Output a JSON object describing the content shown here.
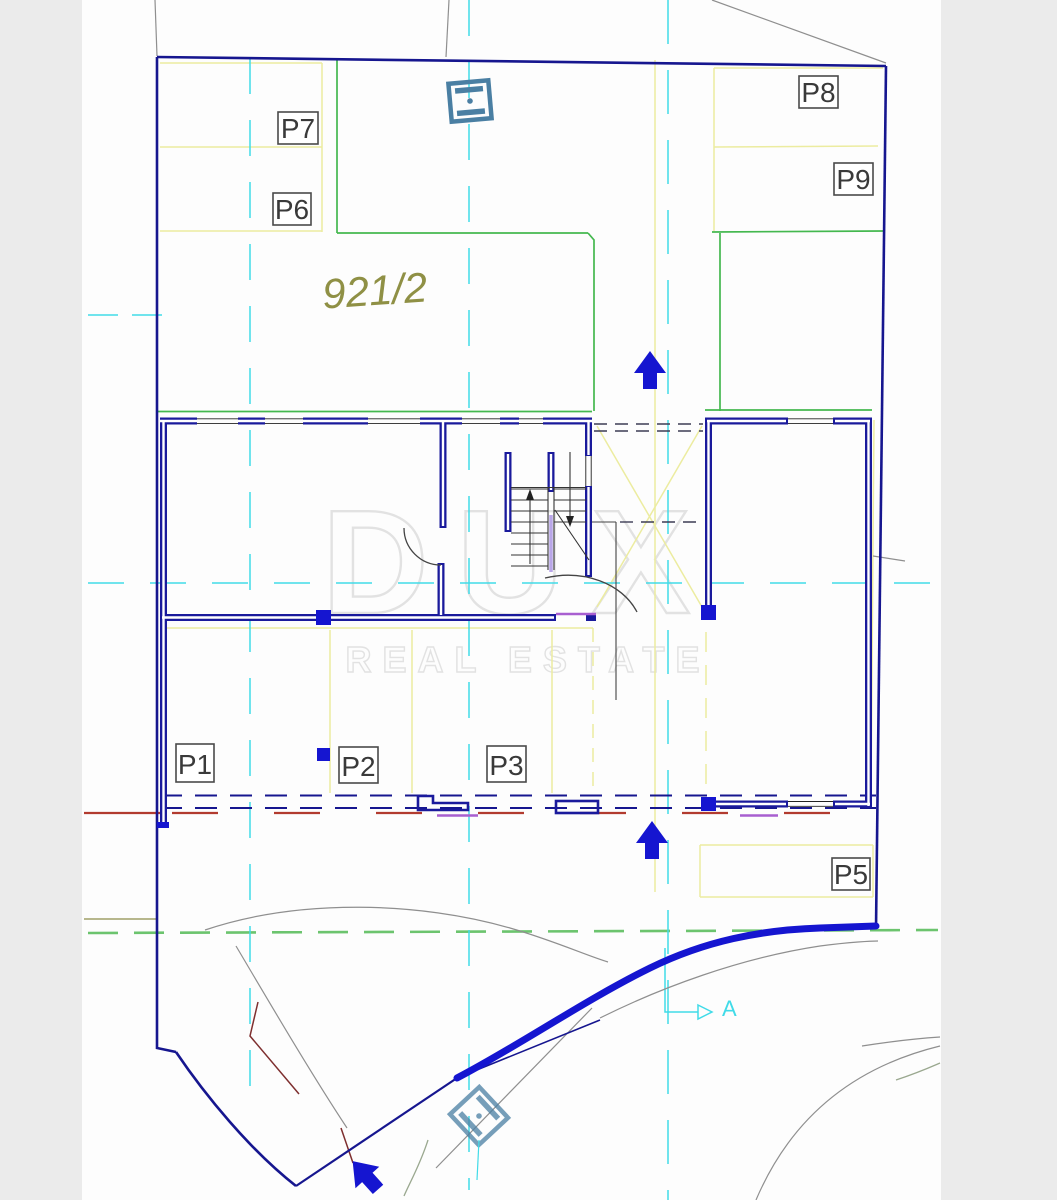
{
  "parcel": {
    "number": "921/2"
  },
  "watermark": {
    "brand": "DUX",
    "tagline": "REAL ESTATE"
  },
  "section": {
    "label": "A"
  },
  "parking": {
    "labels": [
      "P1",
      "P2",
      "P3",
      "P5",
      "P6",
      "P7",
      "P8",
      "P9"
    ]
  },
  "icons": [
    "up-arrow-icon",
    "entrance-arrow-icon",
    "utility-manhole-icon",
    "section-arrow-icon"
  ],
  "colors": {
    "margin_gray": "#ebebeb",
    "paper_white": "#fdfdfd",
    "boundary_navy": "#16168f",
    "wall_navy": "#1a1a9c",
    "accent_blue": "#1515d0",
    "stall_yellow": "#ececa0",
    "boundary_green": "#44b84f",
    "green_dashed": "#6cc46e",
    "axis_cyan": "#41dbe8",
    "parcel_olive": "#8f9045",
    "dashed_red": "#b23b2f",
    "magenta": "#a85fd0",
    "utility_steel_blue": "#4a7fa3",
    "terrain_gray": "#8f8f8f",
    "watermark_gray": "#e2e2e2"
  }
}
